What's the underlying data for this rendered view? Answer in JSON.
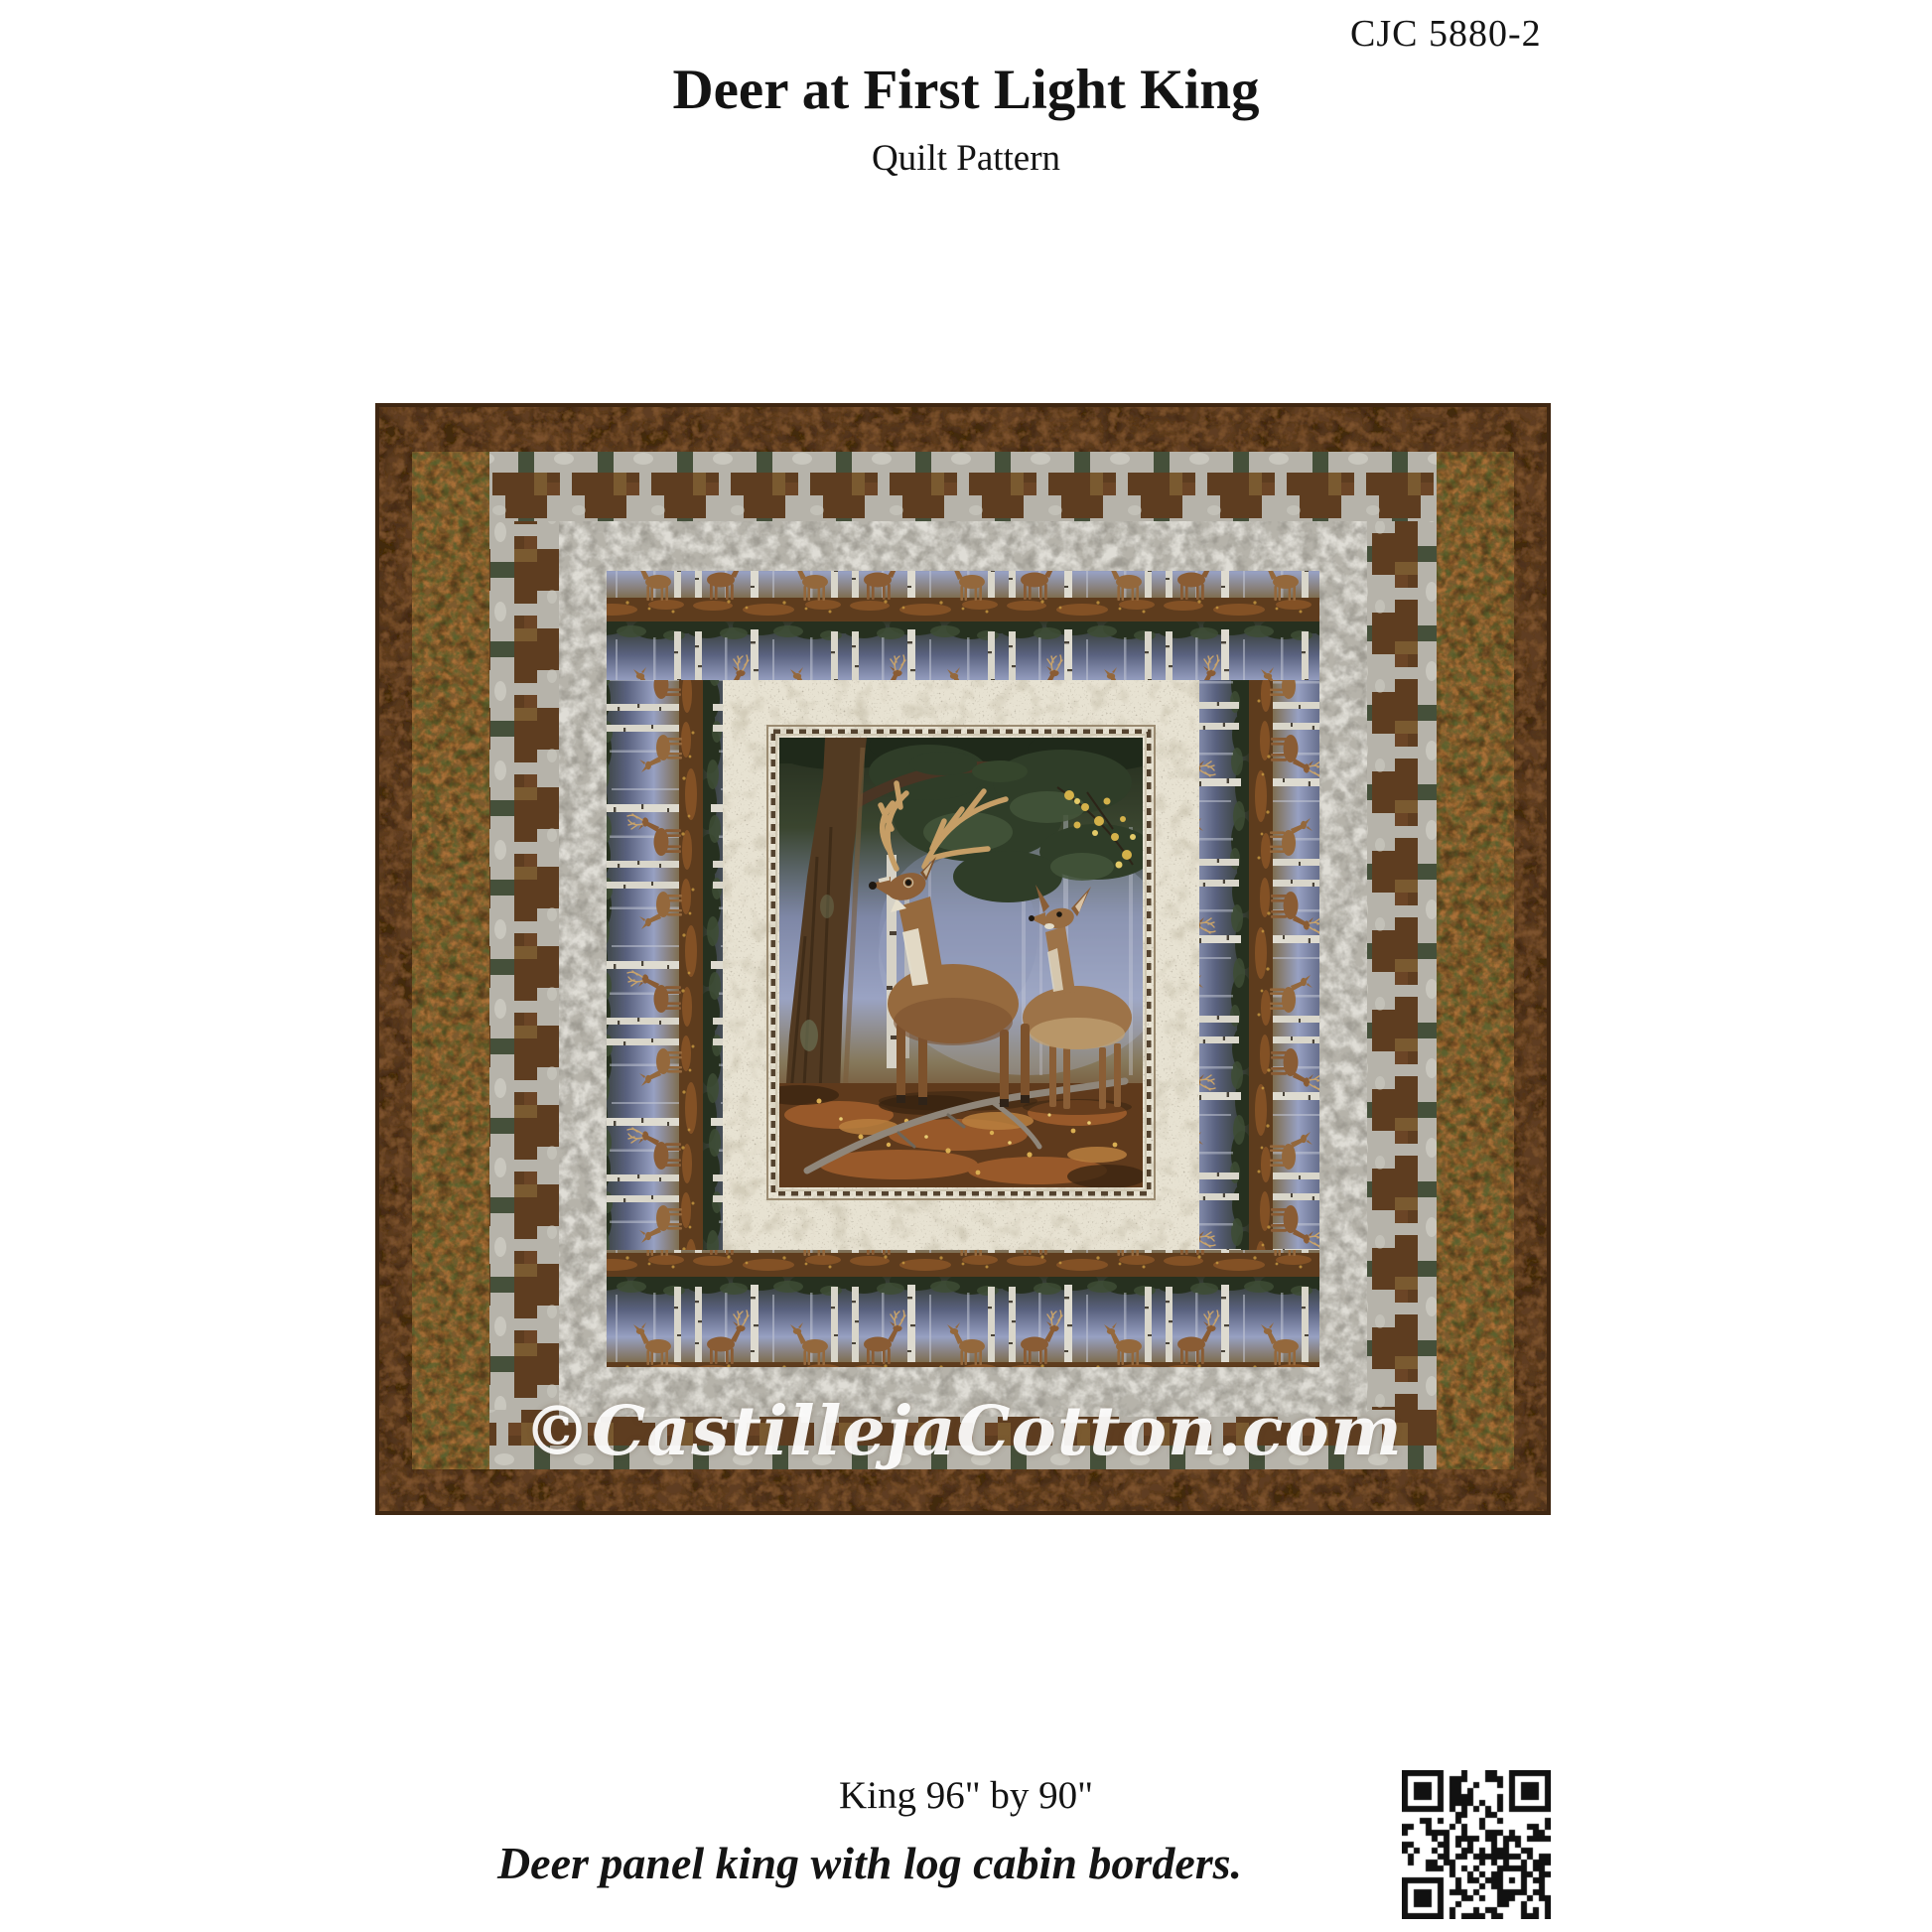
{
  "page": {
    "code": "CJC 5880-2",
    "title": "Deer at First Light King",
    "subtitle": "Quilt Pattern",
    "size_line": "King 96\" by 90\"",
    "tagline": "Deer panel king with log cabin borders.",
    "watermark": "©CastillejaCotton.com"
  },
  "quilt": {
    "colors": {
      "outer_brown": "#5e3d20",
      "leaf_border": "#7c5a2e",
      "grey_marble": "#b6b3aa",
      "pine_green": "#45503a",
      "cream_frame": "#e7e2d2",
      "mist_blue": "#98a1c0",
      "deer_brown": "#96683e",
      "ground_rust": "#6b4423",
      "antler_tan": "#c69e66"
    }
  },
  "qr": {
    "modules": 25,
    "color": "#111111"
  }
}
